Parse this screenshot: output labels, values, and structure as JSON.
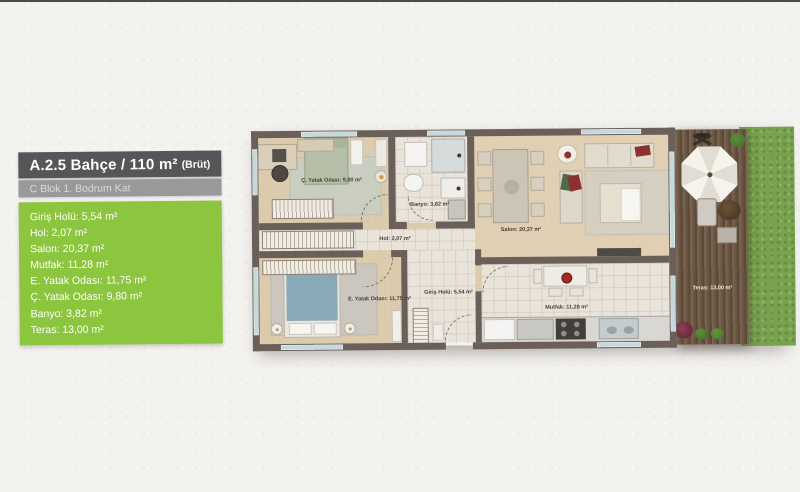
{
  "panel": {
    "title_main": "A.2.5 Bahçe / 110 m²",
    "title_suffix": "(Brüt)",
    "subtitle": "C Blok 1. Bodrum Kat",
    "rooms": [
      "Giriş Holü: 5,54 m²",
      "Hol: 2,07 m²",
      "Salon: 20,37 m²",
      "Mutfak: 11,28 m²",
      "E. Yatak Odası: 11,75 m²",
      "Ç. Yatak Odası: 9,80 m²",
      "Banyo: 3,82 m²",
      "Teras: 13,00 m²"
    ]
  },
  "plan": {
    "labels": {
      "cocuk_yatak": "Ç. Yatak Odası: 9,80 m²",
      "banyo": "Banyo: 3,82 m²",
      "hol": "Hol: 2,07 m²",
      "salon": "Salon: 20,37 m²",
      "e_yatak": "E. Yatak Odası: 11,75 m²",
      "giris": "Giriş Holü: 5,54 m²",
      "mutfak": "Mutfak: 11,28 m²",
      "teras": "Teras: 13,00 m²"
    }
  },
  "colors": {
    "accent_green": "#8CC63E",
    "title_bg": "#565659",
    "subtitle_bg": "#97999B",
    "wall": "#6A6059",
    "grass": "#79A24F",
    "deck": "#6F5843"
  }
}
